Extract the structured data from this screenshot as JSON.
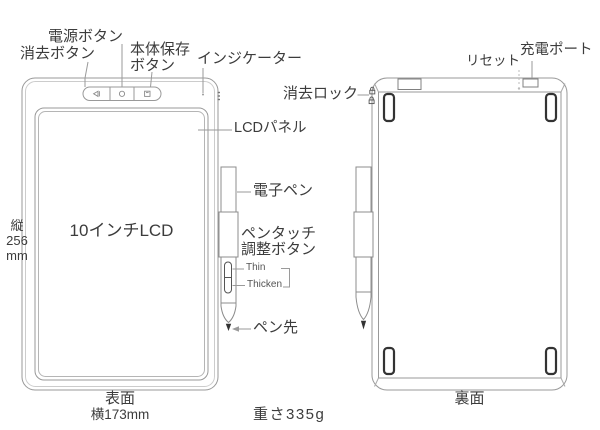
{
  "diagram": {
    "front": {
      "view_label": "表面",
      "width_label": "横173mm",
      "height_lines": [
        "縦",
        "256",
        "mm"
      ],
      "screen_text": "10インチLCD",
      "power_button": "電源ボタン",
      "erase_button": "消去ボタン",
      "save_button_line1": "本体保存",
      "save_button_line2": "ボタン",
      "indicator": "インジケーター",
      "lcd_panel": "LCDパネル",
      "stylus": "電子ペン",
      "pen_touch_line1": "ペンタッチ",
      "pen_touch_line2": "調整ボタン",
      "thin": "Thin",
      "thicken": "Thicken",
      "pen_tip": "ペン先"
    },
    "back": {
      "view_label": "裏面",
      "erase_lock": "消去ロック",
      "reset": "リセット",
      "charge_port": "充電ポート"
    },
    "weight": "重さ335g",
    "icons": {
      "erase_button": "eraser-icon",
      "power_button": "power-icon",
      "save_button": "save-icon",
      "erase_lock": "lock-icon"
    },
    "colors": {
      "outline": "#999999",
      "leader": "#9a9a9a",
      "text": "#3c3c3c",
      "dark_detail": "#333333",
      "background": "#ffffff"
    }
  }
}
